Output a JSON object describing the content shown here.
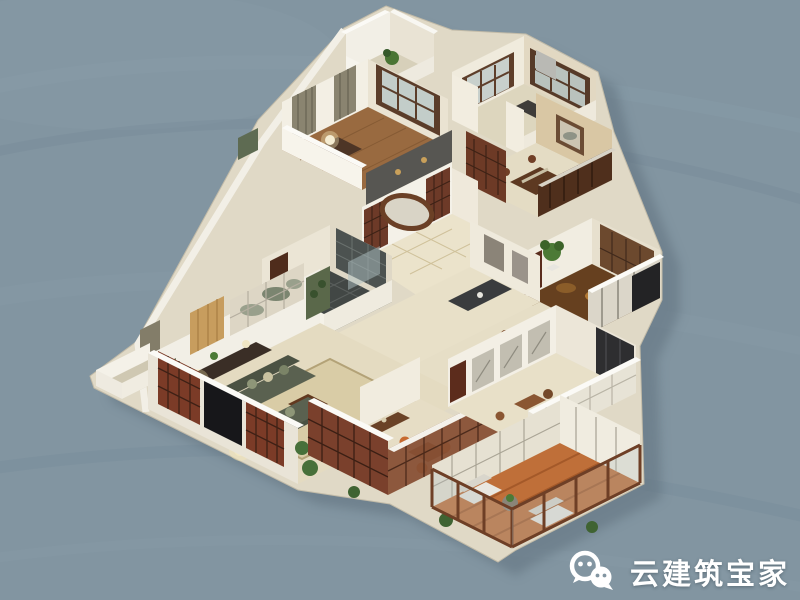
{
  "scene": {
    "type": "isometric 3d floor-plan render",
    "style": "new-chinese interior dollhouse cutaway",
    "rooms": [
      "top-balcony",
      "study",
      "kitchen",
      "dining-room",
      "entry-hall",
      "bathroom",
      "hallway",
      "living-room",
      "tea-room",
      "bedroom",
      "walk-in-closet",
      "sunroom-balcony"
    ]
  },
  "watermark": {
    "icon": "wechat-icon",
    "text": "云建筑宝家"
  },
  "palette": {
    "background": "#8295a1",
    "wall_white": "#f3efe5",
    "floor_beige": "#e6ddc4",
    "wood_red_brown": "#7a402c",
    "balcony_orange": "#bf6f39",
    "closet_brown": "#66401f",
    "sofa_green": "#5a6150",
    "tan_wallpaper": "#d9c7a4",
    "shadow": "#5e6f7c",
    "watermark_text": "#ffffff"
  }
}
